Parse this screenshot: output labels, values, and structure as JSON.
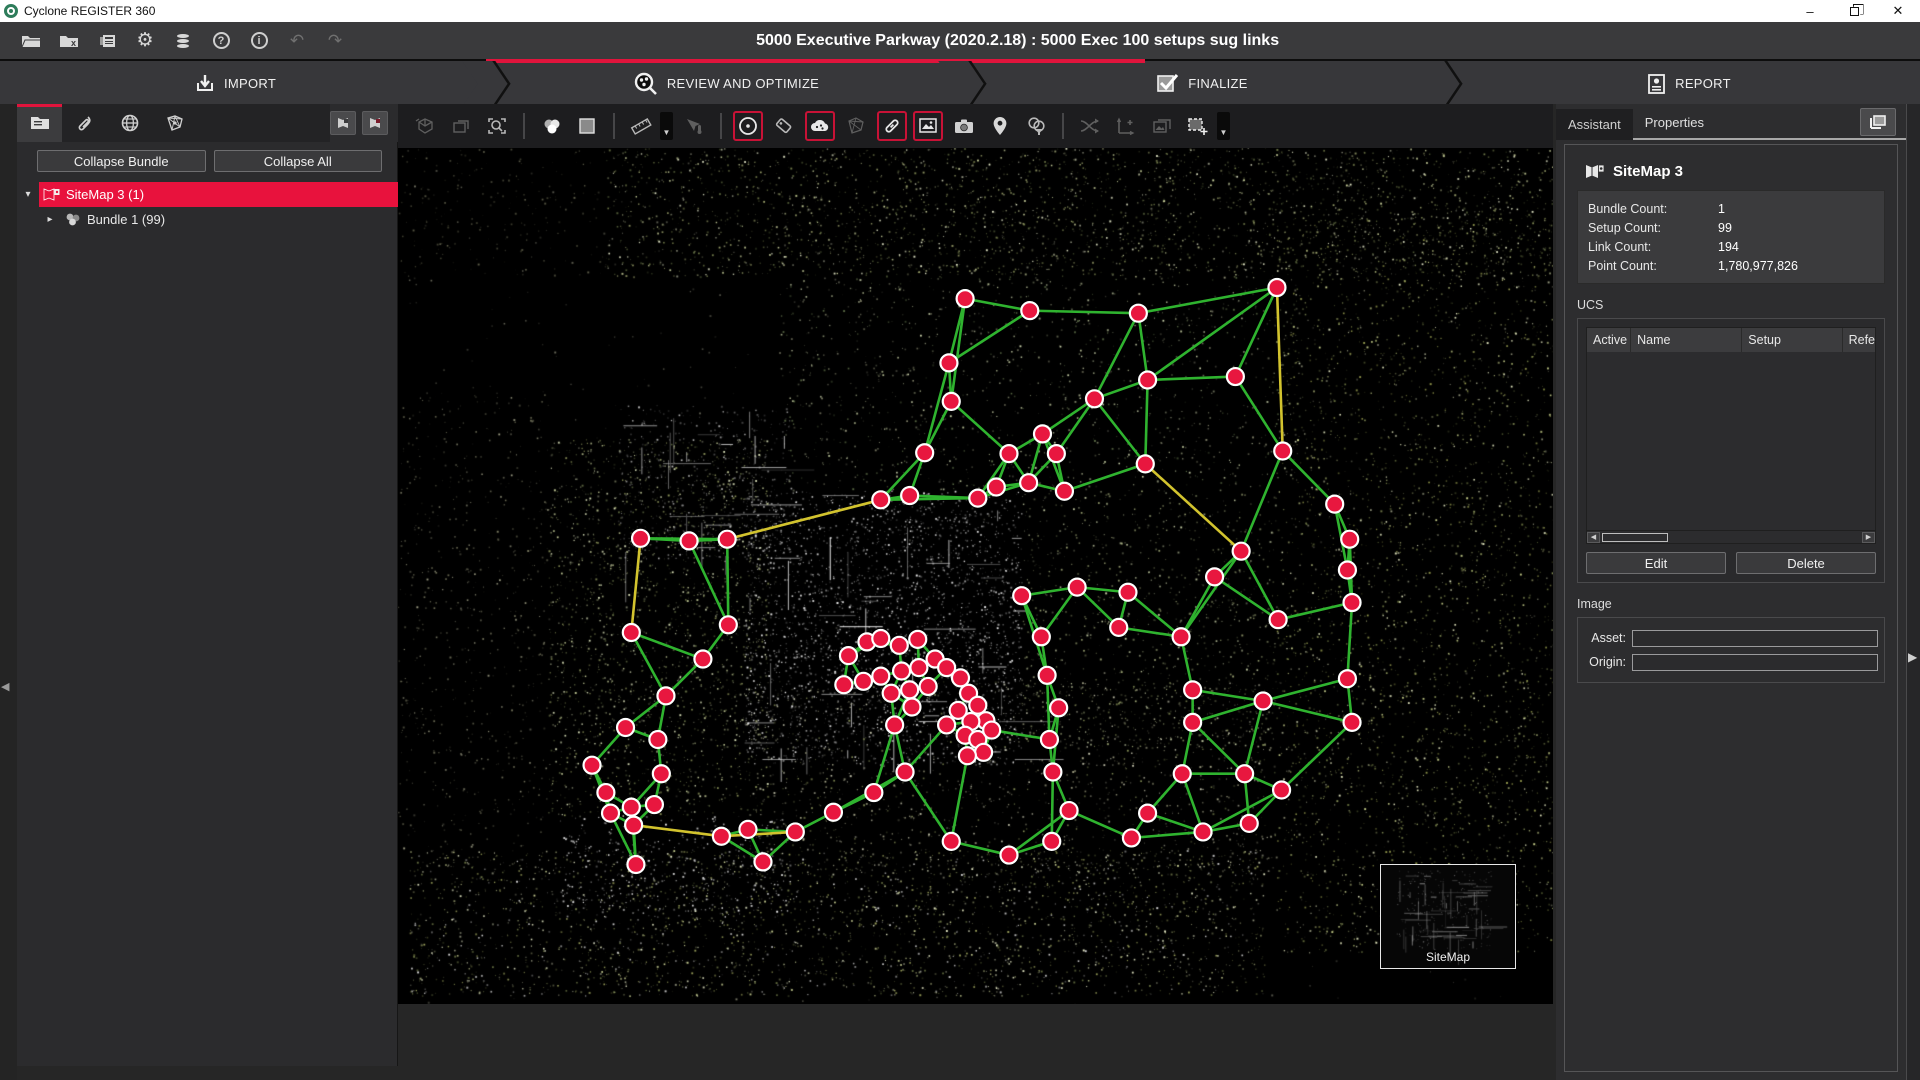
{
  "window": {
    "title": "Cyclone REGISTER 360"
  },
  "menubar": {
    "project_title": "5000 Executive Parkway (2020.2.18) : 5000 Exec 100 setups sug links",
    "buttons": [
      "open-project",
      "close-project",
      "project-details",
      "settings",
      "storage",
      "help",
      "about",
      "undo",
      "redo"
    ],
    "help_glyph": "?",
    "about_glyph": "i",
    "undo_glyph": "↶",
    "redo_glyph": "↷",
    "settings_glyph": "⚙"
  },
  "workflow": {
    "accent": "#e0143c",
    "tabs": [
      {
        "id": "import",
        "label": "IMPORT",
        "active": false
      },
      {
        "id": "review",
        "label": "REVIEW AND OPTIMIZE",
        "active": true
      },
      {
        "id": "finalize",
        "label": "FINALIZE",
        "active": false
      },
      {
        "id": "report",
        "label": "REPORT",
        "active": false
      }
    ]
  },
  "left_panel": {
    "tabs": [
      "project-explorer",
      "attachments",
      "geo",
      "sitemap-network"
    ],
    "collapse_bundle_label": "Collapse Bundle",
    "collapse_all_label": "Collapse All",
    "tree": [
      {
        "label": "SiteMap 3 (1)",
        "selected": true,
        "expanded": true
      },
      {
        "label": "Bundle 1 (99)",
        "selected": false,
        "expanded": false
      }
    ]
  },
  "right_panel": {
    "tabs": [
      {
        "label": "Assistant",
        "active": false
      },
      {
        "label": "Properties",
        "active": true
      }
    ],
    "sitemap": {
      "title": "SiteMap 3",
      "stats": [
        {
          "label": "Bundle Count:",
          "value": "1"
        },
        {
          "label": "Setup Count:",
          "value": "99"
        },
        {
          "label": "Link Count:",
          "value": "194"
        },
        {
          "label": "Point Count:",
          "value": "1,780,977,826"
        }
      ]
    },
    "ucs": {
      "label": "UCS",
      "columns": [
        "Active",
        "Name",
        "Setup",
        "Refe"
      ],
      "rows": [],
      "edit_label": "Edit",
      "delete_label": "Delete"
    },
    "image": {
      "label": "Image",
      "fields": [
        {
          "label": "Asset:",
          "value": ""
        },
        {
          "label": "Origin:",
          "value": ""
        }
      ]
    }
  },
  "viewport": {
    "minimap_label": "SiteMap",
    "colors": {
      "node_fill": "#e8173f",
      "node_stroke": "#ffffff",
      "link_green": "#2fb32f",
      "link_yellow": "#d2c32e",
      "background": "#000000"
    },
    "nodes": [
      [
        49.1,
        17.6
      ],
      [
        54.7,
        19.0
      ],
      [
        64.1,
        19.3
      ],
      [
        76.1,
        16.3
      ],
      [
        47.7,
        25.1
      ],
      [
        72.5,
        26.7
      ],
      [
        64.9,
        27.1
      ],
      [
        60.3,
        29.3
      ],
      [
        47.9,
        29.6
      ],
      [
        55.8,
        33.4
      ],
      [
        52.9,
        35.7
      ],
      [
        57.0,
        35.7
      ],
      [
        54.6,
        39.1
      ],
      [
        51.8,
        39.6
      ],
      [
        57.7,
        40.1
      ],
      [
        50.2,
        40.9
      ],
      [
        45.6,
        35.6
      ],
      [
        41.8,
        41.1
      ],
      [
        44.3,
        40.6
      ],
      [
        64.7,
        36.9
      ],
      [
        76.6,
        35.4
      ],
      [
        81.1,
        41.6
      ],
      [
        82.4,
        45.7
      ],
      [
        21.0,
        45.6
      ],
      [
        25.2,
        45.9
      ],
      [
        28.5,
        45.7
      ],
      [
        20.2,
        56.6
      ],
      [
        23.2,
        64.0
      ],
      [
        19.7,
        67.7
      ],
      [
        22.5,
        69.1
      ],
      [
        28.6,
        55.7
      ],
      [
        26.4,
        59.7
      ],
      [
        39.0,
        59.3
      ],
      [
        40.6,
        57.7
      ],
      [
        41.8,
        57.3
      ],
      [
        43.4,
        58.1
      ],
      [
        45.0,
        57.4
      ],
      [
        46.5,
        59.7
      ],
      [
        45.1,
        60.7
      ],
      [
        43.6,
        61.1
      ],
      [
        41.8,
        61.7
      ],
      [
        40.3,
        62.3
      ],
      [
        38.6,
        62.7
      ],
      [
        42.7,
        63.7
      ],
      [
        44.3,
        63.3
      ],
      [
        45.9,
        62.9
      ],
      [
        47.5,
        60.7
      ],
      [
        48.7,
        61.9
      ],
      [
        49.4,
        63.7
      ],
      [
        50.2,
        65.1
      ],
      [
        50.9,
        66.9
      ],
      [
        49.6,
        67.0
      ],
      [
        48.5,
        65.7
      ],
      [
        47.5,
        67.4
      ],
      [
        49.1,
        68.6
      ],
      [
        50.2,
        69.1
      ],
      [
        51.4,
        68.0
      ],
      [
        50.7,
        70.6
      ],
      [
        49.3,
        71.0
      ],
      [
        44.5,
        65.3
      ],
      [
        43.0,
        67.4
      ],
      [
        55.7,
        57.1
      ],
      [
        54.0,
        52.3
      ],
      [
        58.8,
        51.3
      ],
      [
        63.2,
        51.9
      ],
      [
        67.8,
        57.1
      ],
      [
        70.7,
        50.1
      ],
      [
        73.0,
        47.1
      ],
      [
        82.2,
        49.3
      ],
      [
        82.6,
        53.1
      ],
      [
        76.2,
        55.1
      ],
      [
        62.4,
        56.0
      ],
      [
        56.2,
        61.6
      ],
      [
        57.2,
        65.4
      ],
      [
        56.4,
        69.1
      ],
      [
        56.7,
        72.9
      ],
      [
        68.8,
        63.3
      ],
      [
        74.9,
        64.6
      ],
      [
        68.8,
        67.1
      ],
      [
        67.9,
        73.1
      ],
      [
        73.3,
        73.1
      ],
      [
        76.5,
        75.0
      ],
      [
        82.2,
        62.0
      ],
      [
        82.6,
        67.1
      ],
      [
        16.8,
        72.1
      ],
      [
        18.0,
        75.3
      ],
      [
        20.2,
        77.0
      ],
      [
        22.2,
        76.7
      ],
      [
        18.4,
        77.7
      ],
      [
        20.4,
        79.1
      ],
      [
        22.8,
        73.1
      ],
      [
        28.0,
        80.4
      ],
      [
        30.3,
        79.6
      ],
      [
        34.4,
        79.9
      ],
      [
        37.7,
        77.6
      ],
      [
        41.2,
        75.3
      ],
      [
        43.9,
        72.9
      ],
      [
        47.9,
        81.0
      ],
      [
        52.9,
        82.6
      ],
      [
        56.6,
        81.0
      ],
      [
        58.1,
        77.4
      ],
      [
        63.5,
        80.6
      ],
      [
        64.9,
        77.7
      ],
      [
        69.7,
        79.9
      ],
      [
        73.7,
        78.9
      ],
      [
        20.6,
        83.7
      ],
      [
        31.6,
        83.4
      ]
    ],
    "yellow_links": [
      [
        3,
        20
      ],
      [
        17,
        25
      ],
      [
        23,
        26
      ],
      [
        91,
        93
      ],
      [
        89,
        91
      ],
      [
        19,
        67
      ]
    ],
    "pointcloud_regions": [
      {
        "x": 18,
        "y": 0,
        "w": 82,
        "h": 15,
        "n": 2600,
        "colors": [
          "#9aa06a",
          "#c8cf9a",
          "#717a49",
          "#e8eccc",
          "#55603a"
        ]
      },
      {
        "x": 0,
        "y": 0,
        "w": 18,
        "h": 15,
        "n": 200,
        "colors": [
          "#444433",
          "#666650"
        ]
      },
      {
        "x": 33,
        "y": 15,
        "w": 45,
        "h": 25,
        "n": 1100,
        "colors": [
          "#8a8a70",
          "#b0b890",
          "#5a6a45",
          "#d0d8b0"
        ]
      },
      {
        "x": 76,
        "y": 8,
        "w": 24,
        "h": 86,
        "n": 3200,
        "colors": [
          "#9aa050",
          "#c4cc88",
          "#6a7440",
          "#e4e8c0",
          "#8a945a"
        ]
      },
      {
        "x": 30,
        "y": 40,
        "w": 24,
        "h": 32,
        "n": 2600,
        "strokes": 44,
        "colors": [
          "#c8c8c8",
          "#9a9a9a",
          "#f0f0f0",
          "#6a6a6a",
          "#e0e0e0"
        ]
      },
      {
        "x": 13,
        "y": 34,
        "w": 19,
        "h": 44,
        "n": 1900,
        "colors": [
          "#8f975c",
          "#bcc492",
          "#5d6840",
          "#dde4bc"
        ]
      },
      {
        "x": 19,
        "y": 30,
        "w": 15,
        "h": 18,
        "n": 500,
        "strokes": 26,
        "colors": [
          "#888888",
          "#bbbbbb",
          "#555555"
        ]
      },
      {
        "x": 30,
        "y": 62,
        "w": 46,
        "h": 23,
        "n": 1400,
        "colors": [
          "#7a7a62",
          "#a8a88a",
          "#8a945a",
          "#c8c8b0"
        ]
      },
      {
        "x": 1,
        "y": 82,
        "w": 74,
        "h": 17,
        "n": 2600,
        "colors": [
          "#9aa05a",
          "#c8cf92",
          "#6a7444",
          "#e8ecc8",
          "#d0d0d0"
        ]
      },
      {
        "x": 0,
        "y": 28,
        "w": 13,
        "h": 56,
        "n": 600,
        "colors": [
          "#5a5a48",
          "#7a7a60",
          "#999980"
        ]
      },
      {
        "x": 54,
        "y": 40,
        "w": 22,
        "h": 30,
        "n": 900,
        "colors": [
          "#6a7050",
          "#98a070",
          "#c0c8a0"
        ]
      },
      {
        "x": 14,
        "y": 78,
        "w": 20,
        "h": 12,
        "n": 400,
        "colors": [
          "#cccccc",
          "#eeeeee"
        ]
      },
      {
        "x": 0,
        "y": 0,
        "w": 100,
        "h": 100,
        "n": 900,
        "colors": [
          "#3a3a32",
          "#55554a",
          "#707060"
        ]
      }
    ]
  }
}
